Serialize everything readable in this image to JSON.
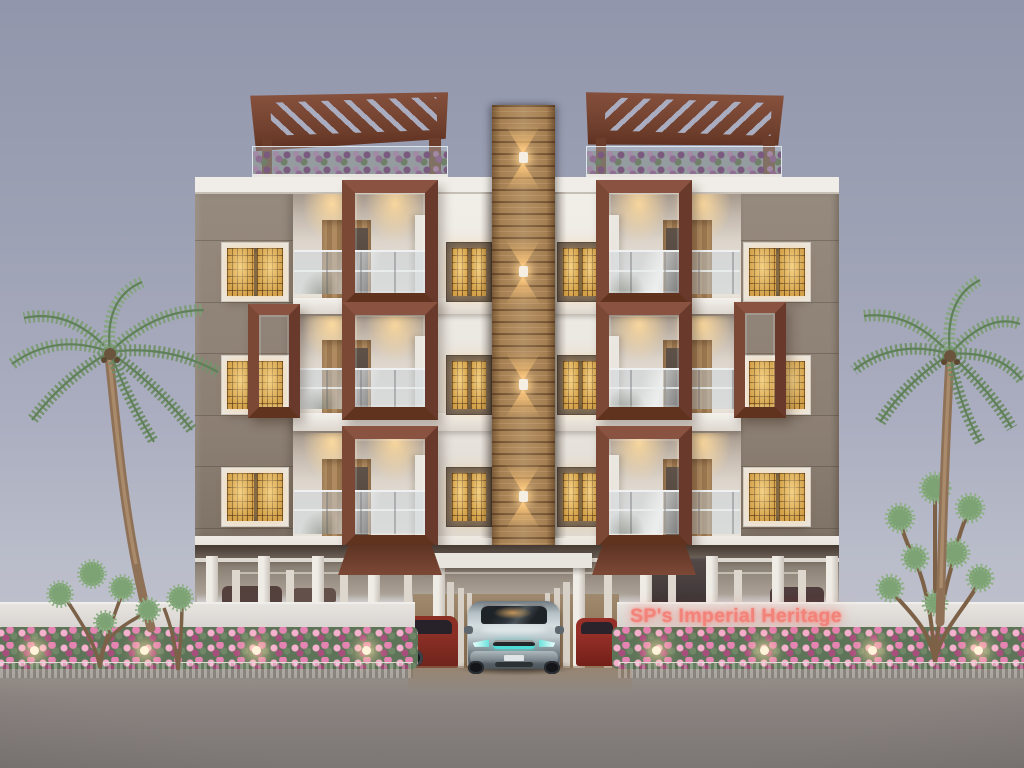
{
  "scene": {
    "description": "Dusk 3D architectural render of a 3-storey apartment building on stilt parking, with rooftop pergolas, glowing lattice windows, palm trees and a flowering compound wall",
    "sign": {
      "text": "SP's Imperial Heritage"
    },
    "building": {
      "floors": 3,
      "stilt_parking": true,
      "balconies_per_floor": 2,
      "lattice_window_columns": 4,
      "facade_sconces": 4,
      "roof_pergolas": 2
    },
    "vehicles": {
      "featured": "silver SUV with teal lights",
      "parked": [
        "red car",
        "red car",
        "distant cars"
      ]
    },
    "landscaping": {
      "palm_trees": 2,
      "ornamental_trees": 3,
      "hedge": "pink bougainvillea",
      "wall_uplights_per_side": 4
    }
  },
  "colors": {
    "sign": "#f2837a",
    "brown": "#7c4836",
    "taupe": "#8f8277",
    "gold": "#c08c35",
    "wood": "#a57f52",
    "teal": "#4fdcd6",
    "flower": "#e583b2",
    "flowerHi": "#f6b1cf",
    "flowerDk": "#a84e7c",
    "leaf": "#7e9d77",
    "leafDark": "#5f8059",
    "road": "#8b8481",
    "skyTop": "#9296ac",
    "skyBottom": "#c6c7cf",
    "wallWhite": "#e7e4e0",
    "cream": "#efece7"
  }
}
